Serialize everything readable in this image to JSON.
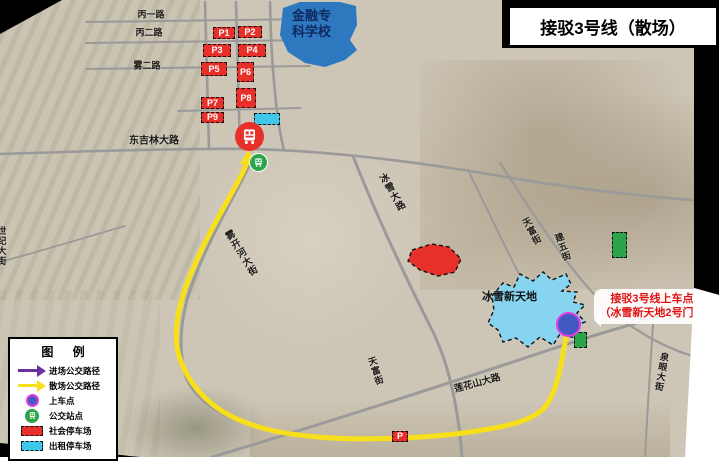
{
  "title": "接驳3号线（散场）",
  "colors": {
    "route_yellow": "#f7e019",
    "enter_purple": "#6a2fa0",
    "parking_red": "#e8302a",
    "taxi_cyan": "#3fc6e8",
    "green_lot": "#2ca44a",
    "boarding_blue": "#4159c0",
    "boarding_ring": "#e23ce2",
    "school_blue": "#2e78c0",
    "venue_blue": "#86d4f0"
  },
  "map": {
    "school_label_line1": "金融专",
    "school_label_line2": "科学校",
    "venue_label": "冰雪新天地",
    "callout": {
      "line1": "接驳3号线上车点",
      "line2": "（冰雪新天地2号门）"
    },
    "road_labels": [
      {
        "text": "丙一路",
        "x": 151,
        "y": 14,
        "rot": 0,
        "v": false,
        "size": 9
      },
      {
        "text": "丙二路",
        "x": 149,
        "y": 32,
        "rot": 0,
        "v": false,
        "size": 9
      },
      {
        "text": "雾二路",
        "x": 147,
        "y": 65,
        "rot": 0,
        "v": false,
        "size": 9
      },
      {
        "text": "东吉林大路",
        "x": 154,
        "y": 139,
        "rot": 0,
        "v": false,
        "size": 10
      },
      {
        "text": "雾开河大街",
        "x": 240,
        "y": 254,
        "rot": -32,
        "v": true,
        "size": 9.5
      },
      {
        "text": "冰雪大路",
        "x": 391,
        "y": 193,
        "rot": -30,
        "v": true,
        "size": 9.5
      },
      {
        "text": "天富街",
        "x": 532,
        "y": 231,
        "rot": -28,
        "v": true,
        "size": 9
      },
      {
        "text": "建五街",
        "x": 563,
        "y": 247,
        "rot": -20,
        "v": true,
        "size": 9
      },
      {
        "text": "莲花山大路",
        "x": 477,
        "y": 382,
        "rot": -15,
        "v": false,
        "size": 9.5
      },
      {
        "text": "天富街",
        "x": 376,
        "y": 371,
        "rot": -18,
        "v": true,
        "size": 9
      },
      {
        "text": "世纪大街",
        "x": 2,
        "y": 246,
        "rot": 0,
        "v": true,
        "size": 9
      },
      {
        "text": "泉眼大街",
        "x": 662,
        "y": 372,
        "rot": 10,
        "v": true,
        "size": 9
      }
    ],
    "parking_markers": [
      {
        "label": "P1",
        "x": 213,
        "y": 27,
        "w": 22,
        "h": 12,
        "type": "red"
      },
      {
        "label": "P2",
        "x": 238,
        "y": 26,
        "w": 24,
        "h": 12,
        "type": "red"
      },
      {
        "label": "P3",
        "x": 203,
        "y": 44,
        "w": 28,
        "h": 13,
        "type": "red"
      },
      {
        "label": "P4",
        "x": 238,
        "y": 44,
        "w": 28,
        "h": 13,
        "type": "red"
      },
      {
        "label": "P5",
        "x": 201,
        "y": 62,
        "w": 26,
        "h": 14,
        "type": "red"
      },
      {
        "label": "P6",
        "x": 237,
        "y": 62,
        "w": 17,
        "h": 20,
        "type": "red"
      },
      {
        "label": "P7",
        "x": 201,
        "y": 97,
        "w": 23,
        "h": 12,
        "type": "red"
      },
      {
        "label": "P8",
        "x": 236,
        "y": 88,
        "w": 20,
        "h": 20,
        "type": "red"
      },
      {
        "label": "P9",
        "x": 201,
        "y": 112,
        "w": 23,
        "h": 11,
        "type": "red"
      },
      {
        "label": "P",
        "x": 392,
        "y": 431,
        "w": 16,
        "h": 11,
        "type": "red"
      },
      {
        "label": "",
        "x": 254,
        "y": 113,
        "w": 26,
        "h": 12,
        "type": "cyan"
      },
      {
        "label": "",
        "x": 612,
        "y": 232,
        "w": 15,
        "h": 26,
        "type": "green"
      },
      {
        "label": "",
        "x": 574,
        "y": 332,
        "w": 13,
        "h": 16,
        "type": "green"
      }
    ]
  },
  "legend": {
    "title": "图  例",
    "items": [
      {
        "symbol": "arrow-purple",
        "label": "进场公交路径"
      },
      {
        "symbol": "arrow-yellow",
        "label": "散场公交路径"
      },
      {
        "symbol": "dot-blue",
        "label": "上车点"
      },
      {
        "symbol": "bus-green",
        "label": "公交站点"
      },
      {
        "symbol": "rect-red",
        "label": "社会停车场"
      },
      {
        "symbol": "rect-cyan",
        "label": "出租停车场"
      }
    ]
  }
}
